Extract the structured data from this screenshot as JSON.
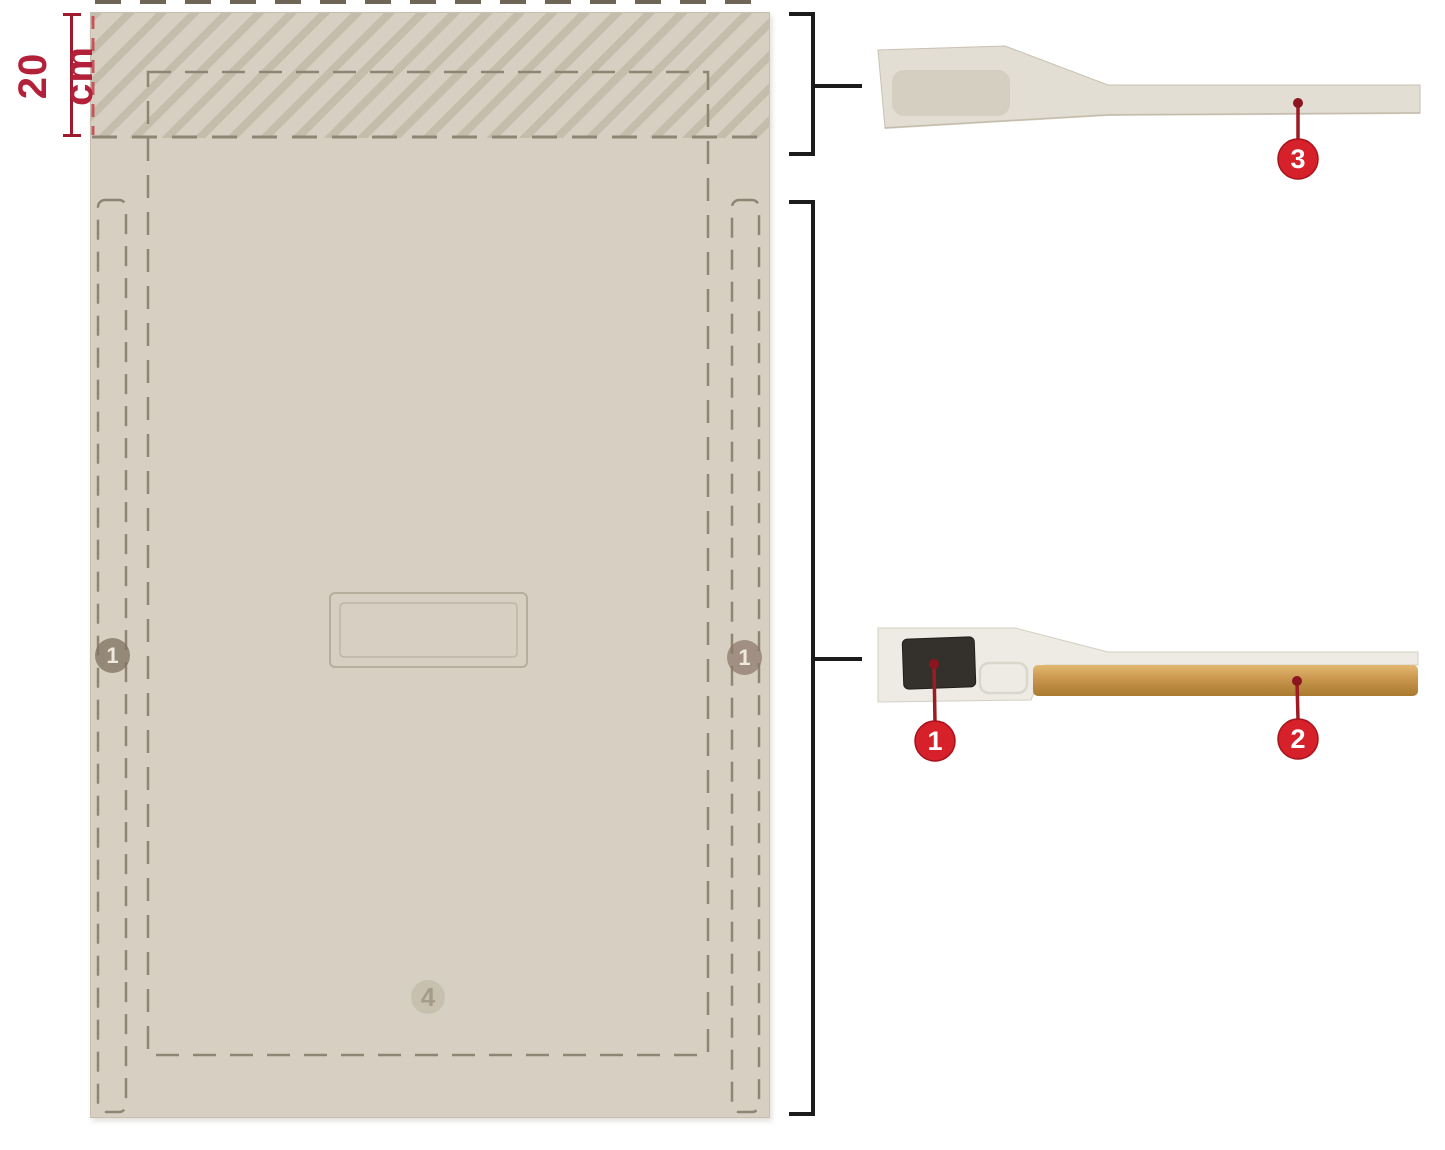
{
  "figure": {
    "dimension": {
      "label": "20 cm",
      "color": "#9e1b2f"
    },
    "panel": {
      "markers": [
        {
          "name": "left-edge-channel-marker",
          "label": "1"
        },
        {
          "name": "right-edge-channel-marker",
          "label": "1"
        },
        {
          "name": "bottom-center-marker",
          "label": "4"
        }
      ]
    },
    "callouts": [
      {
        "name": "mid-detail-black-insert",
        "label": "1"
      },
      {
        "name": "mid-detail-copper-strip",
        "label": "2"
      },
      {
        "name": "top-detail-thin-strip",
        "label": "3"
      }
    ],
    "colors": {
      "background": "#ffffff",
      "panel_beige": "#d7d0c2",
      "hatch_stripe": "#c5bdac",
      "dashed_line": "#8f8575",
      "callout_red": "#d6202a",
      "dimension_red": "#9e1b2f",
      "bracket_black": "#1b1b1b",
      "copper_strip": "#c9964e",
      "insert_black": "#34312c"
    }
  }
}
